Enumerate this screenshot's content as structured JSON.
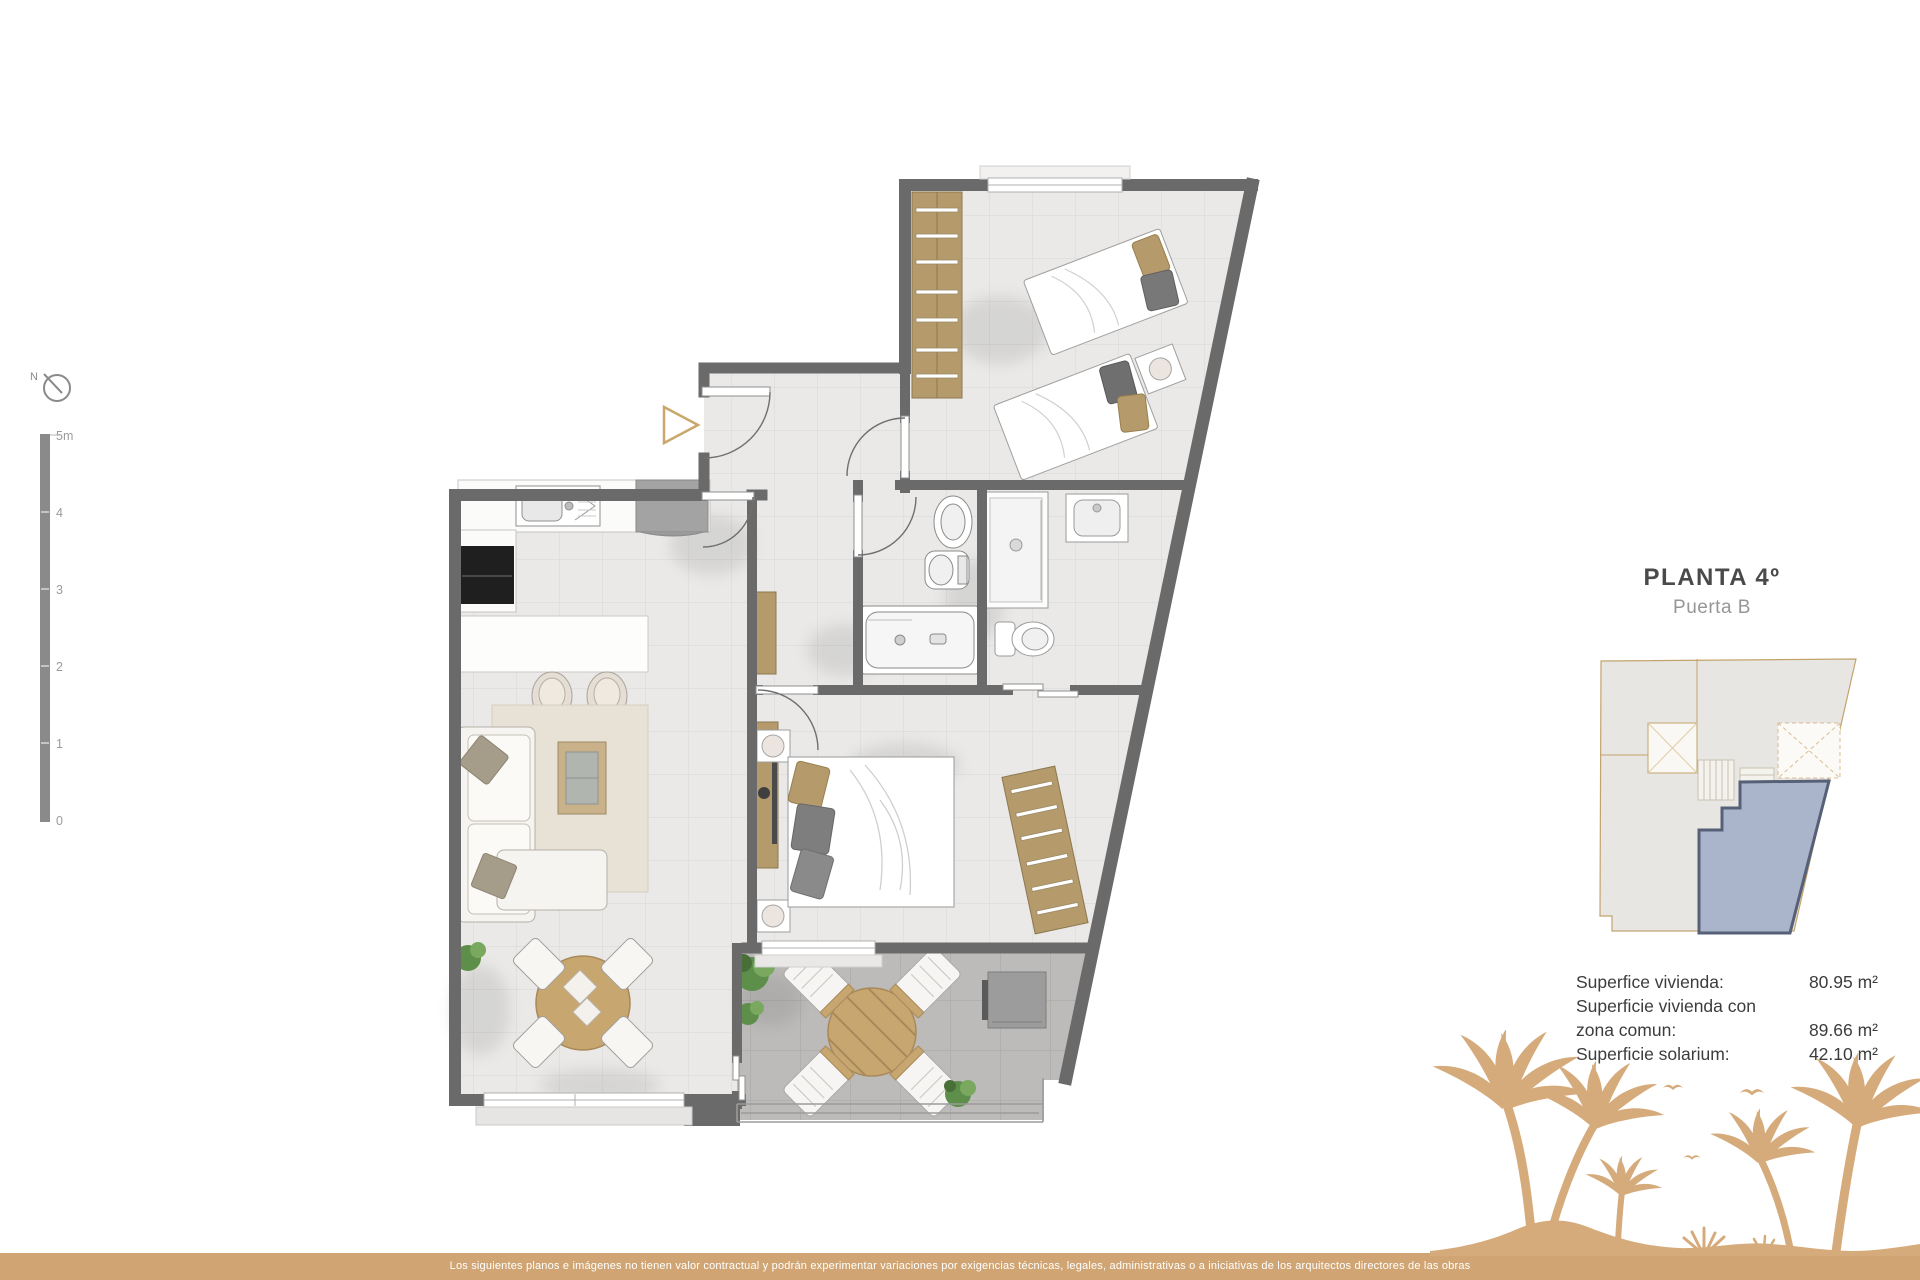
{
  "compass": {
    "label": "N"
  },
  "scale_bar": {
    "labels": [
      "5m",
      "4",
      "3",
      "2",
      "1",
      "0"
    ]
  },
  "info_panel": {
    "title": "PLANTA 4º",
    "subtitle": "Puerta B",
    "areas": {
      "rows": [
        {
          "label": "Superfice vivienda:",
          "value": "80.95 m²"
        },
        {
          "label": "Superficie vivienda con",
          "value": ""
        },
        {
          "label": "zona comun:",
          "value": "89.66 m²"
        },
        {
          "label": "Superficie solarium:",
          "value": "42.10 m²"
        }
      ]
    }
  },
  "footer": {
    "disclaimer": "Los siguientes planos e imágenes no tienen valor contractual y podrán experimentar variaciones por exigencias técnicas, legales, administrativas o a iniciativas de los arquitectos directores de las obras"
  },
  "colors": {
    "accent_tan": "#d0a573",
    "palm_tan": "#d6ab7b",
    "wall_gray": "#6b6a6a",
    "unit_highlight_fill": "#aab4cb",
    "unit_highlight_border": "#566077"
  }
}
